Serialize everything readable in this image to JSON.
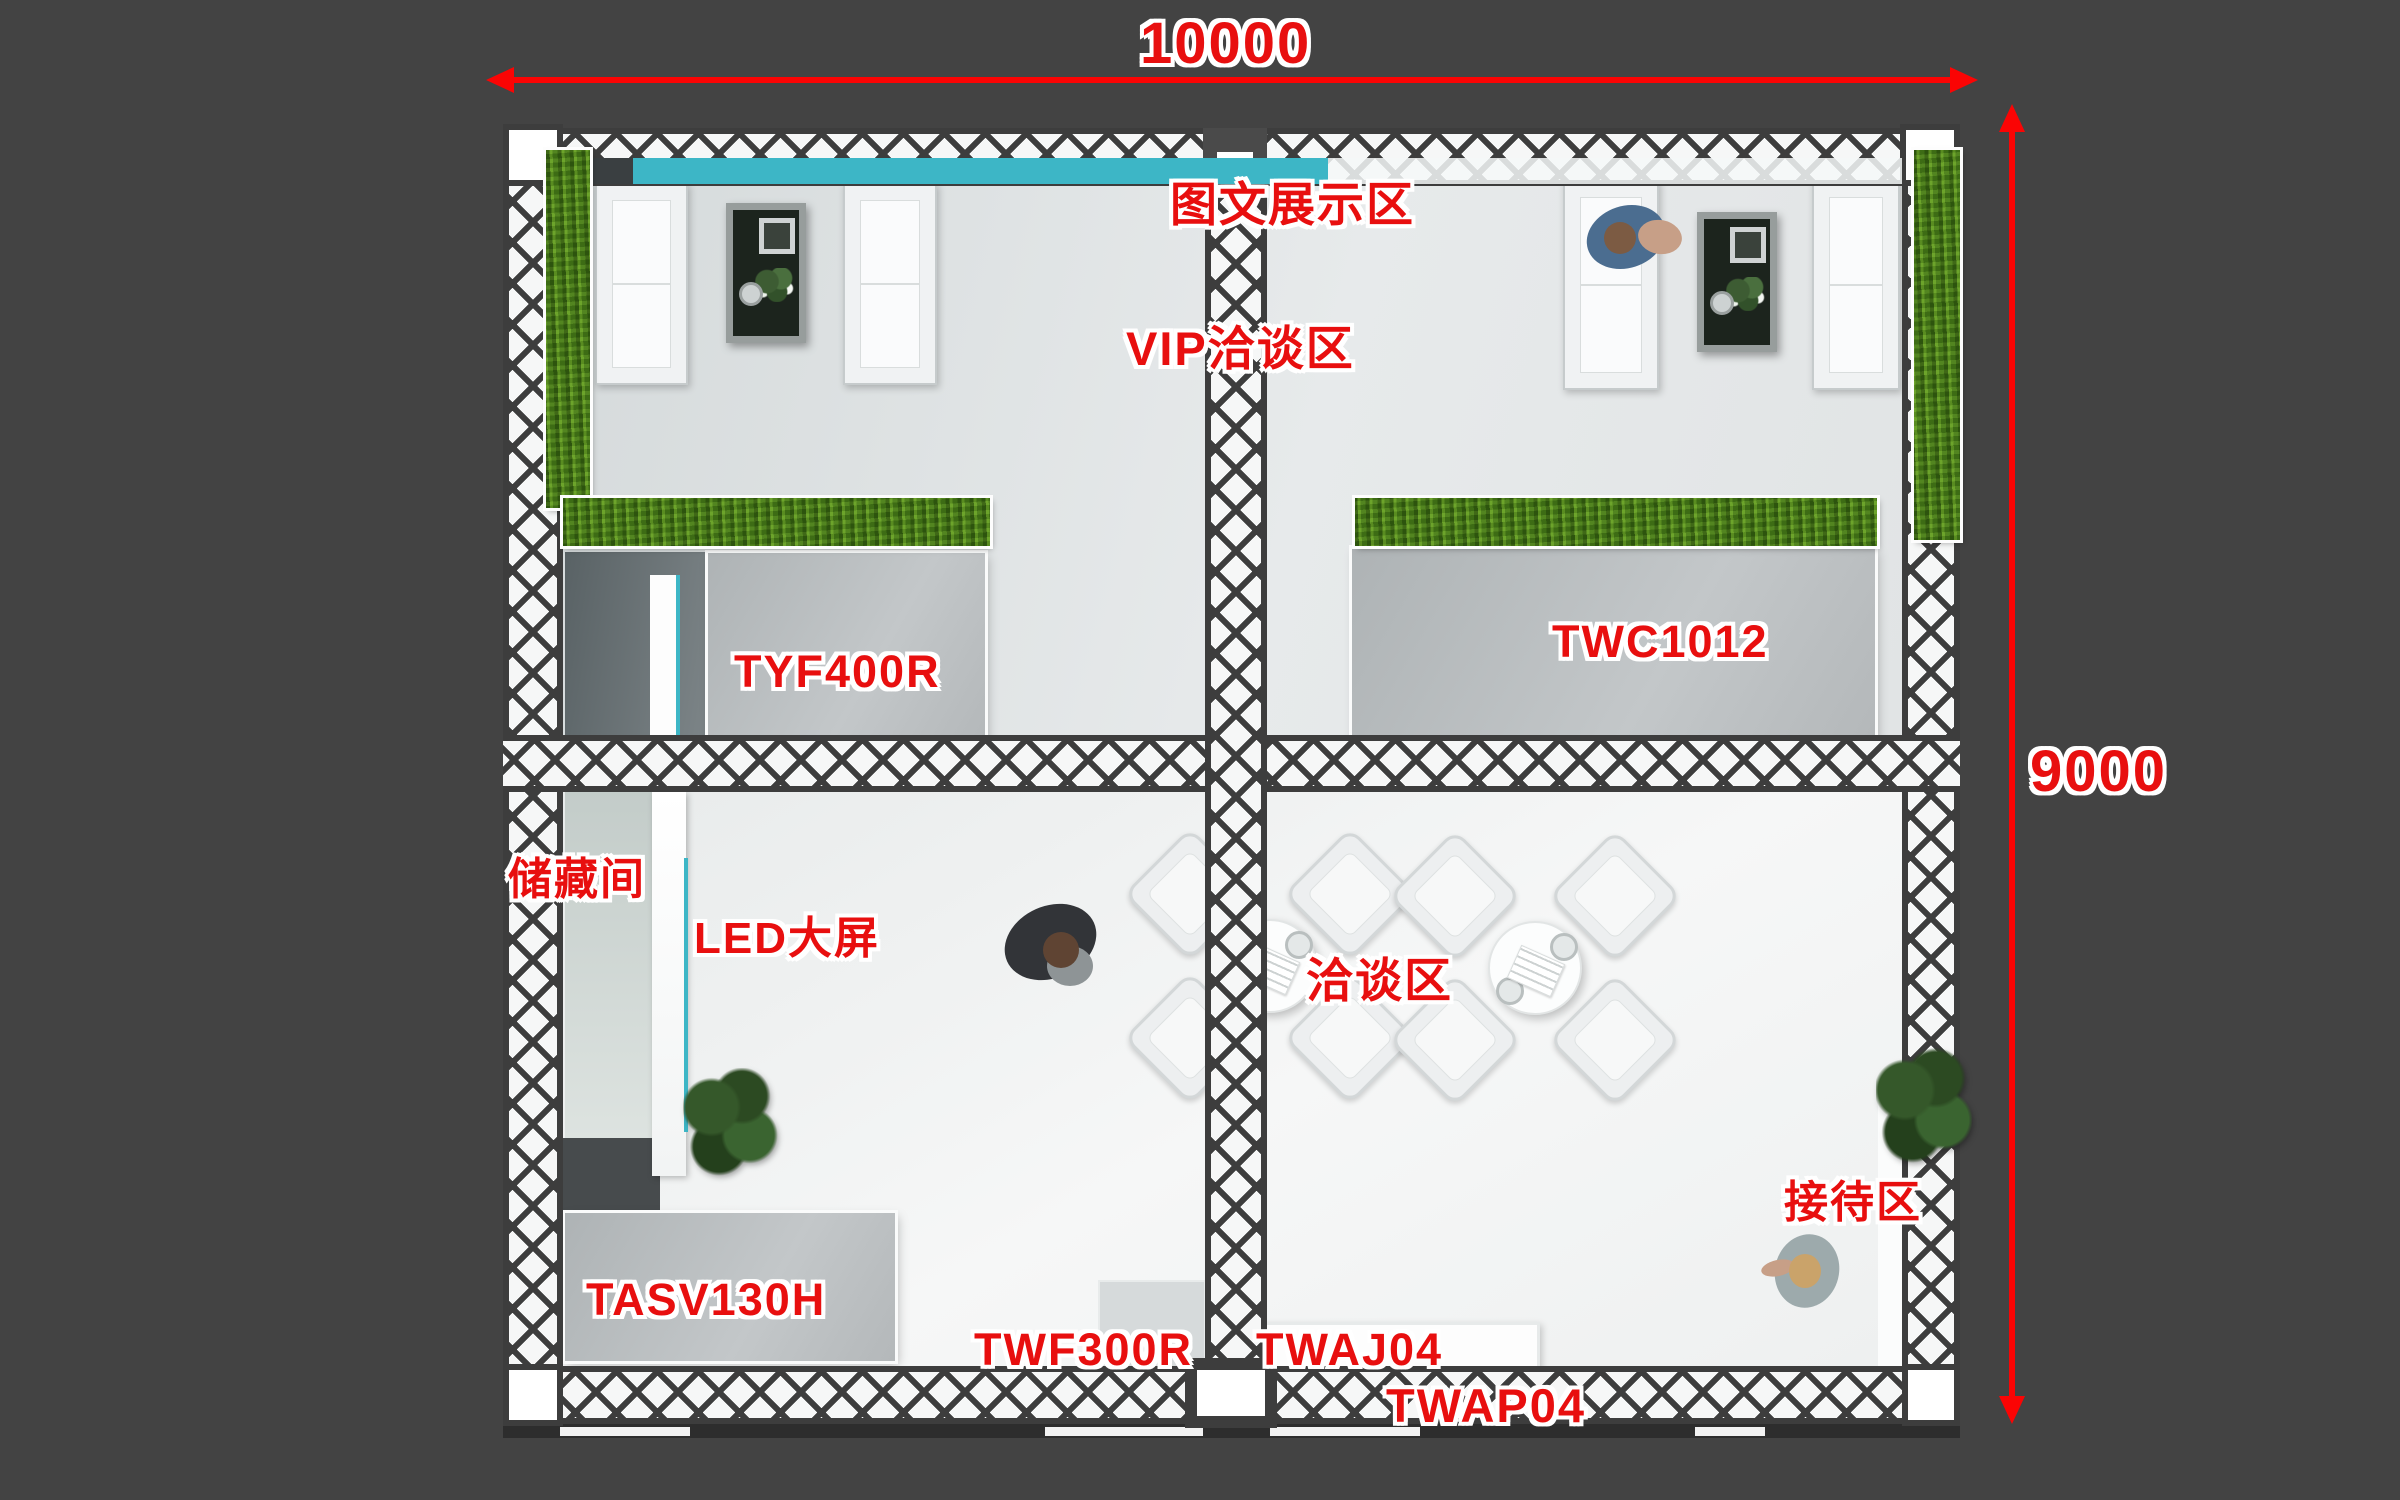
{
  "title": "exhibition booth top view floor plan",
  "dimensions": {
    "width_label": "10000",
    "height_label": "9000"
  },
  "zones": {
    "graphic_display": {
      "label": "图文展示区"
    },
    "vip_meeting": {
      "label": "VIP洽谈区"
    },
    "storage": {
      "label": "储藏间"
    },
    "led_screen": {
      "label": "LED大屏"
    },
    "meeting": {
      "label": "洽谈区"
    },
    "reception": {
      "label": "接待区"
    }
  },
  "products": {
    "tyf400r": {
      "label": "TYF400R"
    },
    "twc1012": {
      "label": "TWC1012"
    },
    "tasv130h": {
      "label": "TASV130H"
    },
    "twf300r": {
      "label": "TWF300R"
    },
    "twaj04": {
      "label": "TWAJ04"
    },
    "twap04": {
      "label": "TWAP04"
    }
  },
  "colors": {
    "bg": "#434343",
    "label-red": "#e80f0f",
    "dim-red": "#fb0404",
    "teal": "#3db6c6",
    "grass": "#4c7c1b",
    "truss-line": "#3d3d3d",
    "truss-bg": "#f6f7f7",
    "floor-upper": "#dfe3e4",
    "floor-lower": "#eef0f1",
    "panel-gray": "#b9bdbf",
    "table-dark": "#1c241d"
  }
}
